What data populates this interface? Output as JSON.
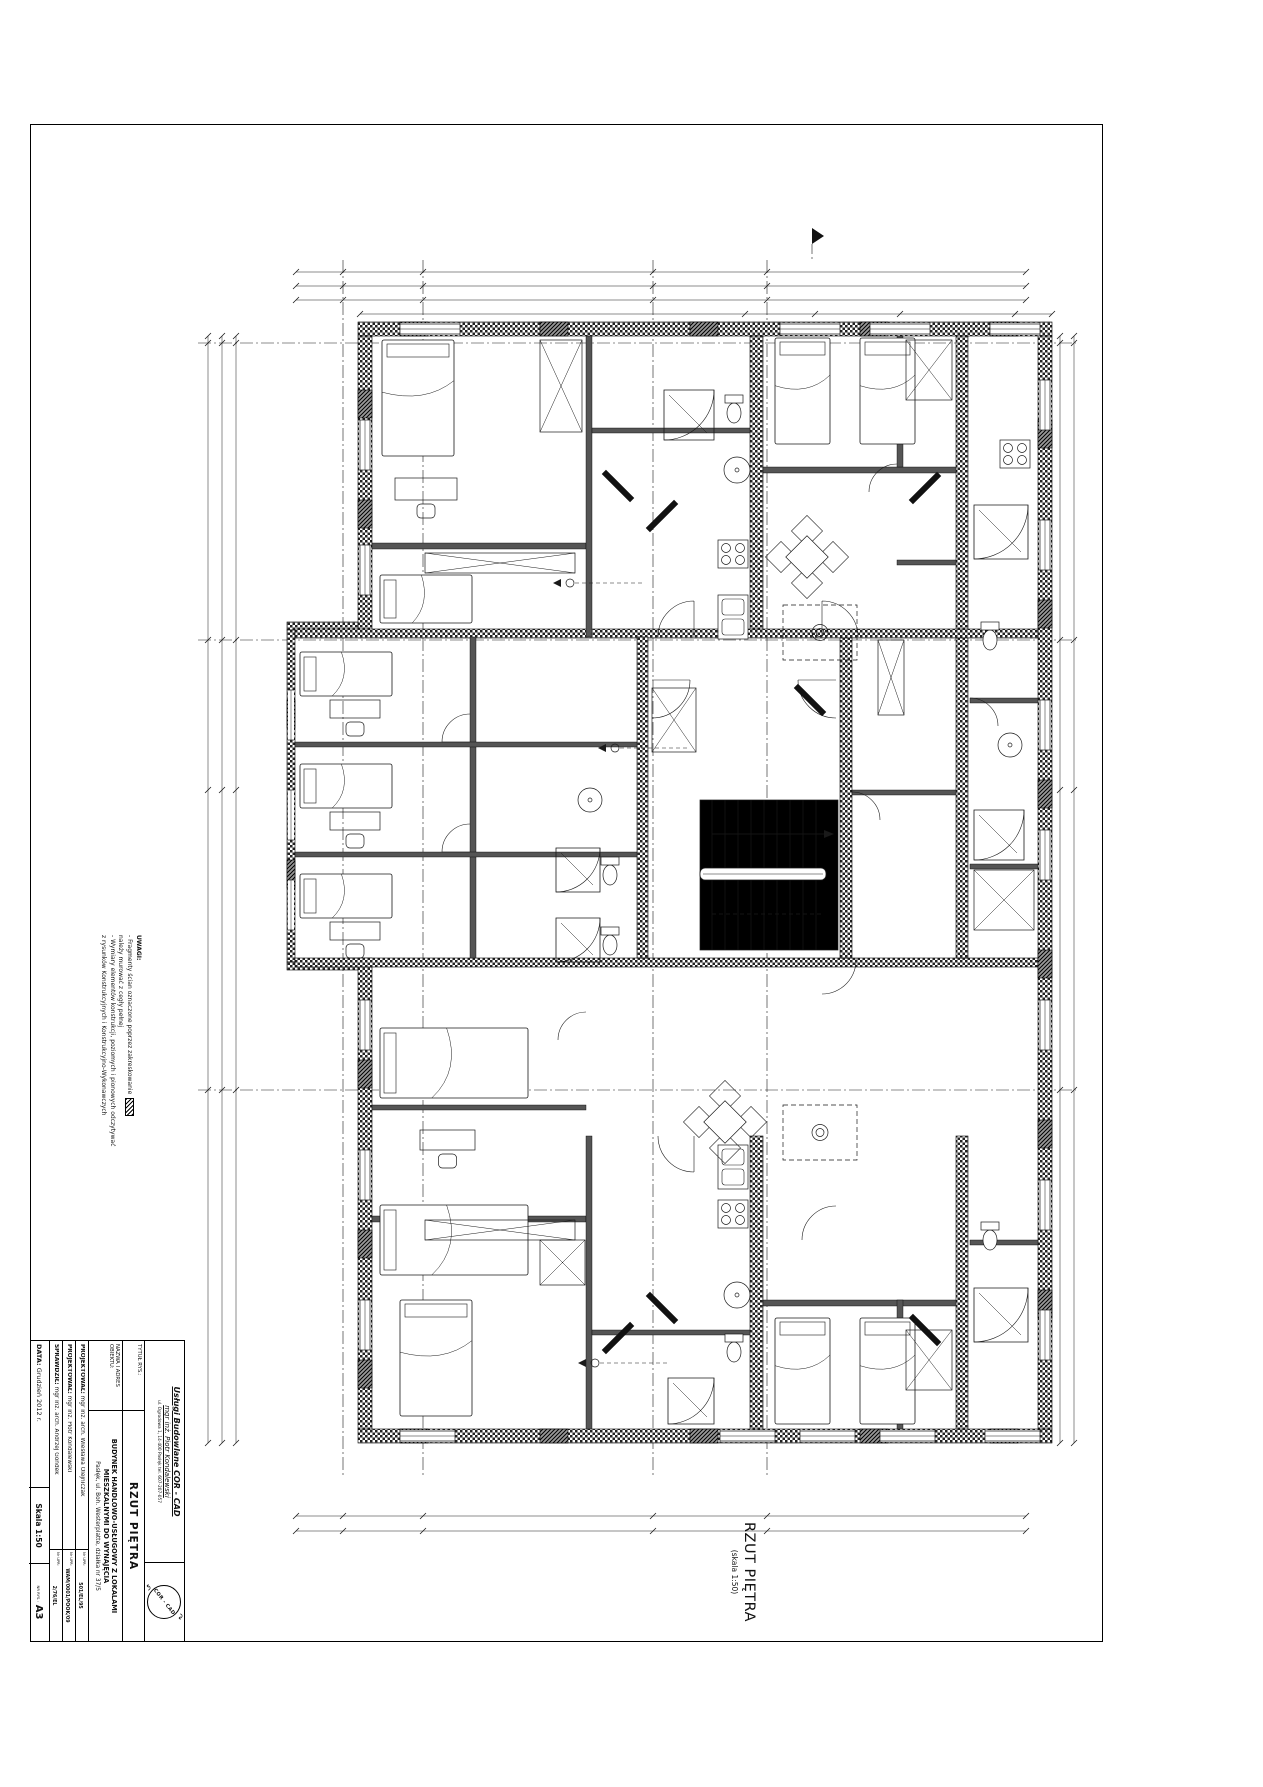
{
  "title_block": {
    "company_line1": "Usługi Budowlane  COR - CAD",
    "company_line2": "mgr inż. Piotr Kondalewski",
    "company_line3": "ul. Ogrodowa 1, 14-400 Pasłęk tel. 607-207-057",
    "logo_text": "COR - CAD",
    "tytul_label": "TYTUŁ RYS.:",
    "tytul": "RZUT PIĘTRA",
    "nazwa_label": "NAZWA I ADRES OBIEKTU:",
    "nazwa1": "BUDYNEK HANDLOWO-USŁUGOWY Z LOKALAMI MIESZKALNYMI DO WYNAJĘCIA",
    "nazwa2": "Pasłęk, ul. Boh. Westerplatte, działka nr 37/5",
    "proj1_label": "PROJEKTOWAŁ:",
    "proj1": "mgr inż. arch. Wiesława Olejniczak",
    "proj1_upr_label": "Nr UPR:",
    "proj1_upr": "501/EL/95",
    "proj2_label": "PROJEKTOWAŁ:",
    "proj2": "mgr inż. Piotr Kondalewski",
    "proj2_upr_label": "Nr UPR:",
    "proj2_upr": "WAM/0001/POOK/09",
    "spr_label": "SPRAWDZIŁ:",
    "spr": "mgr inż. arch. Andrzej Gondek",
    "spr_upr_label": "Nr UPR:",
    "spr_upr": "2/76/EL",
    "data_label": "DATA:",
    "data": "Grudzień 2012 r.",
    "skala": "Skala 1:50",
    "nr_rys_label": "NR RYS.:",
    "format": "A3"
  },
  "plan_title": {
    "main": "RZUT PIĘTRA",
    "sub": "(skala 1:50)"
  },
  "notes": {
    "heading": "UWAGI:",
    "lines": [
      "- Fragmenty ścian oznaczone poprzez zakreskowanie",
      "  należy murować z cegły pełnej",
      "- Wymiary elementów konstrukcji, poziomych i pionowych odczytywać",
      "  z rysunków Konstrukcyjnych i Konstrukcyjno-Wykonawczych"
    ]
  },
  "stairs_note": "22x 18,18x 28,5",
  "grid": {
    "letters": [
      {
        "t": "G",
        "x": 343,
        "y": 251
      },
      {
        "t": "F",
        "x": 423,
        "y": 251
      },
      {
        "t": "D",
        "x": 653,
        "y": 251
      },
      {
        "t": "C",
        "x": 767,
        "y": 251
      },
      {
        "t": "G",
        "x": 343,
        "y": 1487
      },
      {
        "t": "F",
        "x": 423,
        "y": 1487
      },
      {
        "t": "D",
        "x": 653,
        "y": 1487
      },
      {
        "t": "C",
        "x": 767,
        "y": 1487
      }
    ],
    "numbers": [
      {
        "t": "1",
        "x": 187,
        "y": 343
      },
      {
        "t": "3",
        "x": 187,
        "y": 640
      },
      {
        "t": "6",
        "x": 187,
        "y": 1090
      },
      {
        "t": "1",
        "x": 1085,
        "y": 343
      },
      {
        "t": "3",
        "x": 1085,
        "y": 640
      },
      {
        "t": "6",
        "x": 1085,
        "y": 1090
      }
    ],
    "flags": [
      {
        "t": "A",
        "x": 812,
        "y": 238,
        "dir": "s"
      },
      {
        "t": "A",
        "x": 715,
        "y": 1482,
        "dir": "n"
      },
      {
        "t": "B",
        "x": 187,
        "y": 788,
        "dir": "e"
      },
      {
        "t": "B",
        "x": 1074,
        "y": 788,
        "dir": "w"
      }
    ]
  },
  "rooms": [
    {
      "t": "13.3",
      "x": 530,
      "y": 517
    },
    {
      "t": "13.4",
      "x": 530,
      "y": 592
    },
    {
      "t": "13.2",
      "x": 702,
      "y": 467
    },
    {
      "t": "13.5",
      "x": 838,
      "y": 496
    },
    {
      "t": "13.1",
      "x": 686,
      "y": 648
    },
    {
      "t": "14.4",
      "x": 952,
      "y": 445
    },
    {
      "t": "14.1",
      "x": 916,
      "y": 660
    },
    {
      "t": "12.1",
      "x": 578,
      "y": 757
    },
    {
      "t": "12.3",
      "x": 607,
      "y": 852
    },
    {
      "t": "7.1",
      "x": 977,
      "y": 758
    },
    {
      "t": "7.2",
      "x": 1014,
      "y": 688
    },
    {
      "t": "7.3",
      "x": 1014,
      "y": 930
    },
    {
      "t": "10.2",
      "x": 700,
      "y": 1337
    },
    {
      "t": "10.3",
      "x": 607,
      "y": 1380
    },
    {
      "t": "11.2",
      "x": 448,
      "y": 1000
    },
    {
      "t": "11.1",
      "x": 580,
      "y": 1057
    },
    {
      "t": "9.4",
      "x": 500,
      "y": 1162
    }
  ],
  "dims": [
    {
      "t": "1504",
      "x": 660,
      "y": 268
    },
    {
      "t": "1564",
      "x": 660,
      "y": 282
    },
    {
      "t": "27",
      "x": 308,
      "y": 296
    },
    {
      "t": "750",
      "x": 424,
      "y": 296
    },
    {
      "t": "431",
      "x": 566,
      "y": 296
    },
    {
      "t": "218",
      "x": 702,
      "y": 296
    },
    {
      "t": "100",
      "x": 848,
      "y": 296
    },
    {
      "t": "50",
      "x": 887,
      "y": 296
    },
    {
      "t": "100",
      "x": 926,
      "y": 296
    },
    {
      "t": "50",
      "x": 963,
      "y": 296
    },
    {
      "t": "100",
      "x": 1000,
      "y": 296
    },
    {
      "t": "75",
      "x": 1035,
      "y": 296
    },
    {
      "t": "111",
      "x": 380,
      "y": 310
    },
    {
      "t": "31",
      "x": 412,
      "y": 310
    },
    {
      "t": "458",
      "x": 520,
      "y": 310
    },
    {
      "t": "318",
      "x": 992,
      "y": 310
    },
    {
      "t": "27",
      "x": 308,
      "y": 1512
    },
    {
      "t": "750",
      "x": 424,
      "y": 1512
    },
    {
      "t": "431",
      "x": 566,
      "y": 1512
    },
    {
      "t": "218",
      "x": 702,
      "y": 1512
    },
    {
      "t": "650",
      "x": 900,
      "y": 1512
    },
    {
      "t": "318",
      "x": 992,
      "y": 1512
    },
    {
      "t": "1504",
      "x": 660,
      "y": 1527
    },
    {
      "t": "1564",
      "x": 660,
      "y": 1541
    },
    {
      "t": "650",
      "x": 212,
      "y": 470,
      "r": 1
    },
    {
      "t": "163",
      "x": 212,
      "y": 640,
      "r": 1
    },
    {
      "t": "196",
      "x": 212,
      "y": 800,
      "r": 1
    },
    {
      "t": "281",
      "x": 212,
      "y": 950,
      "r": 1
    },
    {
      "t": "178",
      "x": 212,
      "y": 1085,
      "r": 1
    },
    {
      "t": "650",
      "x": 1066,
      "y": 470,
      "r": 1
    },
    {
      "t": "163",
      "x": 1066,
      "y": 640,
      "r": 1
    },
    {
      "t": "196",
      "x": 1066,
      "y": 800,
      "r": 1
    },
    {
      "t": "281",
      "x": 1066,
      "y": 950,
      "r": 1
    },
    {
      "t": "178",
      "x": 1066,
      "y": 1085,
      "r": 1
    },
    {
      "t": "292,5",
      "x": 470,
      "y": 403
    },
    {
      "t": "37",
      "x": 700,
      "y": 397
    },
    {
      "t": "70,5",
      "x": 736,
      "y": 397
    },
    {
      "t": "398",
      "x": 528,
      "y": 622
    },
    {
      "t": "220",
      "x": 735,
      "y": 618
    },
    {
      "t": "300",
      "x": 762,
      "y": 472
    },
    {
      "t": "223",
      "x": 830,
      "y": 588
    },
    {
      "t": "116",
      "x": 898,
      "y": 587
    },
    {
      "t": "366,5",
      "x": 905,
      "y": 742
    },
    {
      "t": "100",
      "x": 690,
      "y": 740
    },
    {
      "t": "23,5",
      "x": 642,
      "y": 738
    },
    {
      "t": "170",
      "x": 597,
      "y": 833,
      "r": 1
    },
    {
      "t": "237",
      "x": 1027,
      "y": 435
    },
    {
      "t": "236",
      "x": 1016,
      "y": 520,
      "r": 1
    },
    {
      "t": "255",
      "x": 1004,
      "y": 940,
      "r": 1
    },
    {
      "t": "115",
      "x": 1008,
      "y": 772
    },
    {
      "t": "165",
      "x": 932,
      "y": 920
    },
    {
      "t": "250",
      "x": 953,
      "y": 903,
      "r": 1
    },
    {
      "t": "398",
      "x": 525,
      "y": 1183
    },
    {
      "t": "292,5",
      "x": 478,
      "y": 1196
    },
    {
      "t": "37",
      "x": 690,
      "y": 1352
    },
    {
      "t": "70,5",
      "x": 722,
      "y": 1352
    },
    {
      "t": "58",
      "x": 756,
      "y": 1352
    },
    {
      "t": "82",
      "x": 800,
      "y": 1352
    },
    {
      "t": "hp=85",
      "x": 790,
      "y": 347
    },
    {
      "t": "hp=85",
      "x": 905,
      "y": 347
    },
    {
      "t": "hp=85",
      "x": 1015,
      "y": 347
    },
    {
      "t": "hp=85",
      "x": 800,
      "y": 1415
    },
    {
      "t": "hp=85",
      "x": 905,
      "y": 1415
    }
  ],
  "window_markers": [
    {
      "id": "O6",
      "x": 346,
      "y": 430,
      "dims": "100\n150",
      "dx": -16,
      "dy": 0
    },
    {
      "id": "O6",
      "x": 346,
      "y": 570,
      "dims": "100\n150",
      "dx": -16,
      "dy": 0
    },
    {
      "id": "O6",
      "x": 346,
      "y": 795,
      "dims": "100\n150",
      "dx": -16,
      "dy": 0
    },
    {
      "id": "O6",
      "x": 346,
      "y": 1025,
      "dims": "100\n150",
      "dx": -16,
      "dy": 0
    },
    {
      "id": "O6",
      "x": 346,
      "y": 1175,
      "dims": "100\n150",
      "dx": -16,
      "dy": 0
    },
    {
      "id": "O1",
      "x": 745,
      "y": 310,
      "dims": "150\n100",
      "dx": 0,
      "dy": 13
    },
    {
      "id": "O6",
      "x": 815,
      "y": 310,
      "dims": "150\n100",
      "dx": 0,
      "dy": 13
    },
    {
      "id": "O6",
      "x": 900,
      "y": 310,
      "dims": "150\n100",
      "dx": 0,
      "dy": 13
    },
    {
      "id": "O4",
      "x": 1015,
      "y": 310,
      "dims": "150\n100",
      "dx": 0,
      "dy": 13
    },
    {
      "id": "O5",
      "x": 745,
      "y": 1466,
      "dims": "150\n100",
      "dx": 0,
      "dy": -14
    },
    {
      "id": "O6",
      "x": 815,
      "y": 1466,
      "dims": "150\n100",
      "dx": 0,
      "dy": -14
    },
    {
      "id": "O6",
      "x": 892,
      "y": 1466,
      "dims": "150\n100",
      "dx": 0,
      "dy": -14
    },
    {
      "id": "O6",
      "x": 985,
      "y": 1466,
      "dims": "150\n100",
      "dx": 0,
      "dy": -14
    }
  ],
  "door_markers": [
    {
      "id": "D6",
      "x": 620,
      "y": 512,
      "dims": "80\n205",
      "dx": 16,
      "dy": 0
    },
    {
      "id": "D6",
      "x": 647,
      "y": 779,
      "dims": "90\n205",
      "dx": -17,
      "dy": 0
    },
    {
      "id": "D7",
      "x": 845,
      "y": 642,
      "dims": "80\n205",
      "dx": 17,
      "dy": 0
    },
    {
      "id": "D8",
      "x": 840,
      "y": 770,
      "dims": "95\n205",
      "dx": 17,
      "dy": 0
    },
    {
      "id": "D5",
      "x": 1012,
      "y": 1415,
      "dims": "90\n205",
      "dx": -18,
      "dy": 0
    },
    {
      "id": "D6",
      "x": 700,
      "y": 1065,
      "dims": "90\n205",
      "dx": 17,
      "dy": 0
    }
  ],
  "schedules": [
    {
      "x": 713,
      "y": 517,
      "w": 100,
      "h": 53,
      "id": "13",
      "title": "LOKAL MIESZKALNY NR 5",
      "rows": [
        [
          "13.1",
          "przedpokój",
          "5,28m²"
        ],
        [
          "13.2",
          "łazienka",
          "3,70m²"
        ],
        [
          "13.3",
          "pokój",
          "12,74m²"
        ],
        [
          "13.4",
          "pokój",
          "13,18m²"
        ],
        [
          "13.5",
          "salon z aneksem",
          "18,36m²"
        ]
      ],
      "total_label": "razem pow. użytk.",
      "total": "53,26m²"
    },
    {
      "x": 913,
      "y": 517,
      "w": 76,
      "h": 53,
      "id": "14",
      "title": "LOKAL MIESZKALNY NR 6",
      "rows": [
        [
          "14.1",
          "przedpokój",
          "2,88m²"
        ],
        [
          "14.2",
          "łazienka",
          "4,04m²"
        ],
        [
          "14.3",
          "kuchnia",
          "3,90m²"
        ],
        [
          "14.4",
          "sypialnia",
          "7,98m²"
        ],
        [
          "14.5",
          "salon",
          "18,98m²"
        ]
      ],
      "total_label": "razem pow. użytk.",
      "total": "37,78m²"
    },
    {
      "x": 943,
      "y": 805,
      "w": 85,
      "h": 59,
      "id": "8",
      "title": "POMIESZCZENIA ADMINISTRACYJNO-BIUROWE",
      "rows": [
        [
          "8.1",
          "wc personelu",
          "1,40m²"
        ],
        [
          "8.2",
          "pom. socjalne",
          "3,15m²"
        ],
        [
          "8.3",
          "biuro",
          "4,53m²"
        ],
        [
          "8.4",
          "biuro",
          "14,01m²"
        ]
      ],
      "total_label": "razem pow. użytk.",
      "total": "23,09m²"
    },
    {
      "x": 505,
      "y": 1002,
      "w": 76,
      "h": 42,
      "id": "11",
      "title": "LOKAL MIESZKALNY NR 3",
      "rows": [
        [
          "11.1",
          "przedpokój",
          "2,67m²"
        ],
        [
          "11.2",
          "pokój",
          "12,95m²"
        ],
        [
          "11.3",
          "łazienka",
          "3,14m²"
        ]
      ],
      "total_label": "razem pow. użytk.",
      "total": "18,76m²"
    },
    {
      "x": 913,
      "y": 1085,
      "w": 76,
      "h": 53,
      "id": "10",
      "title": "LOKAL MIESZKALNY NR 2",
      "rows": [
        [
          "10.1",
          "przedpokój",
          "2,88m²"
        ],
        [
          "10.2",
          "łazienka",
          "4,04m²"
        ],
        [
          "10.3",
          "kuchnia",
          "3,90m²"
        ],
        [
          "10.4",
          "sypialnia",
          "7,98m²"
        ],
        [
          "10.5",
          "salon",
          "18,98m²"
        ]
      ],
      "total_label": "razem pow. użytk.",
      "total": "37,78m²"
    }
  ],
  "colors": {
    "line": "#111111",
    "wall_fill": "#222222",
    "partition": "#555555"
  }
}
